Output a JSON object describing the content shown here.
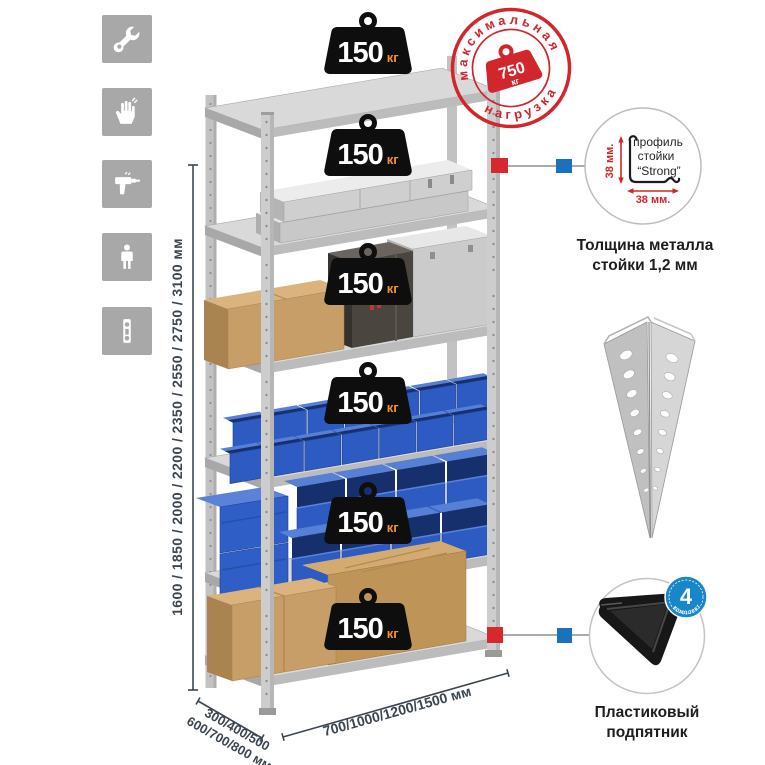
{
  "sidebar": {
    "icons": [
      {
        "name": "wrench"
      },
      {
        "name": "gloves"
      },
      {
        "name": "drill"
      },
      {
        "name": "person"
      },
      {
        "name": "level"
      }
    ]
  },
  "rack": {
    "height_label": "1600 / 1850 / 2000 / 2200 / 2350 / 2550 / 2750 / 3100 мм",
    "depth_label": [
      "300/400/500",
      "600/700/800 мм"
    ],
    "width_label": "700/1000/1200/1500 мм",
    "shelf_loads": [
      {
        "value": "150",
        "unit": "кг"
      },
      {
        "value": "150",
        "unit": "кг"
      },
      {
        "value": "150",
        "unit": "кг"
      },
      {
        "value": "150",
        "unit": "кг"
      },
      {
        "value": "150",
        "unit": "кг"
      },
      {
        "value": "150",
        "unit": "кг"
      }
    ]
  },
  "stamp": {
    "arc_top": "максимальная",
    "arc_bottom": "нагрузка",
    "value": "750",
    "unit": "кг"
  },
  "profile_callout": {
    "line1": "профиль",
    "line2": "стойки",
    "line3": "“Strong”",
    "dim_vertical": "38 мм.",
    "dim_horizontal": "38 мм.",
    "caption1": "Толщина металла",
    "caption2": "стойки 1,2 мм"
  },
  "foot_callout": {
    "badge_number": "4",
    "badge_label": "в комплекте",
    "caption1": "Пластиковый",
    "caption2": "подпятник"
  },
  "colors": {
    "stamp_red": "#d0262c",
    "marker_red": "#d7282e",
    "marker_blue": "#1a72bd",
    "badge_black": "#0e0e0e",
    "kg_orange": "#f0932d",
    "bin_blue": "#2e5bc2",
    "dim_text": "#3c4650",
    "icon_gray": "#a8a8a8"
  }
}
